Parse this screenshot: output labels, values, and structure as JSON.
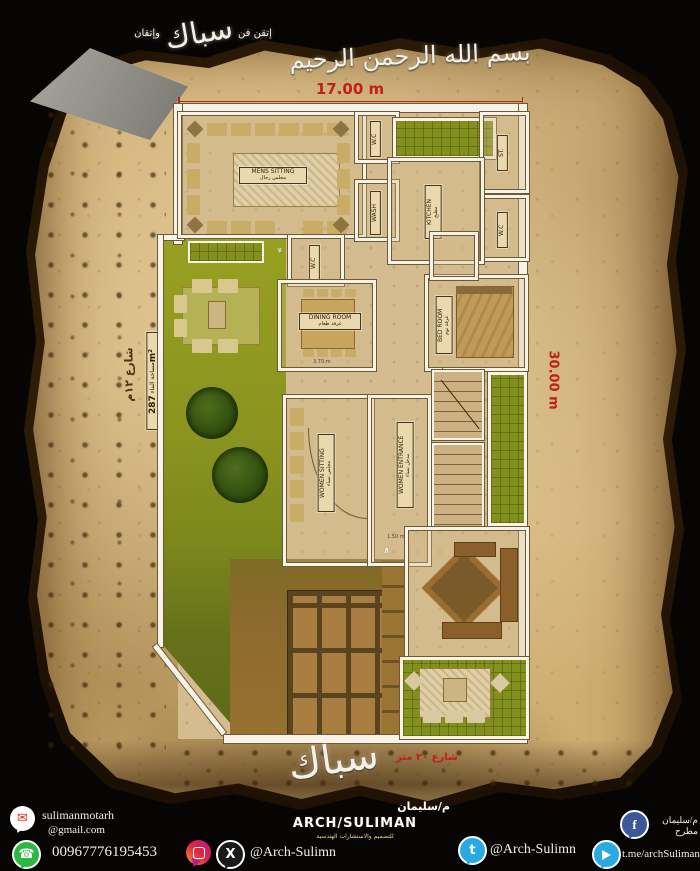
{
  "header": {
    "bismillah": "بسم الله الرحمن الرحيم",
    "signature_center": "سباك",
    "signature_right": "إتقن فن",
    "signature_left": "وإتقان"
  },
  "dimensions": {
    "top": "17.00 m",
    "right": "30.00 m",
    "area": "287m²",
    "area_caption": "مساحة البناء",
    "street_left": "شارع ١٢م",
    "street_bottom": "شارع ٢٠ متر",
    "dining_width": "3.70 m",
    "entrance_width": "1.50 m"
  },
  "rooms": {
    "mens_sitting": {
      "en": "MENS SITTING",
      "ar": "مجلس رجال"
    },
    "kitchen": {
      "en": "KITCHEN",
      "ar": "مطبخ"
    },
    "dining": {
      "en": "DINING ROOM",
      "ar": "غرفة طعام"
    },
    "bedroom": {
      "en": "BED ROOM",
      "ar": "غرفة نوم"
    },
    "women_sitting": {
      "en": "WOMEN SITTING",
      "ar": "مجلس نساء"
    },
    "women_entrance": {
      "en": "WOMEN ENTRANCE",
      "ar": "مدخل نساء"
    },
    "wc_a": "W.C",
    "wc_b": "W.C",
    "wc_c": "W.C",
    "store": "ST.",
    "wash": "WASH"
  },
  "branding": {
    "logo_calligraphy": "سباك",
    "architect_ar": "م/سليمان",
    "architect_en": "ARCH/SULIMAN",
    "tagline_ar": "للتصميم والاستشارات الهندسية"
  },
  "contacts": {
    "email_name": "sulimanmotarh",
    "email_domain": "@gmail.com",
    "phone": "00967776195453",
    "social_handle": "@Arch-Sulimn",
    "facebook_name": "م/سليمان مطرح",
    "twitter_handle": "@Arch-Sulimn",
    "telegram_url": "t.me/archSuliman"
  },
  "colors": {
    "dimension_red": "#c41f16",
    "parchment": "#cfae72",
    "garden_green": "#8a941f",
    "wall_white": "#f7f3e8",
    "garage_brown": "#8d6a2e"
  }
}
